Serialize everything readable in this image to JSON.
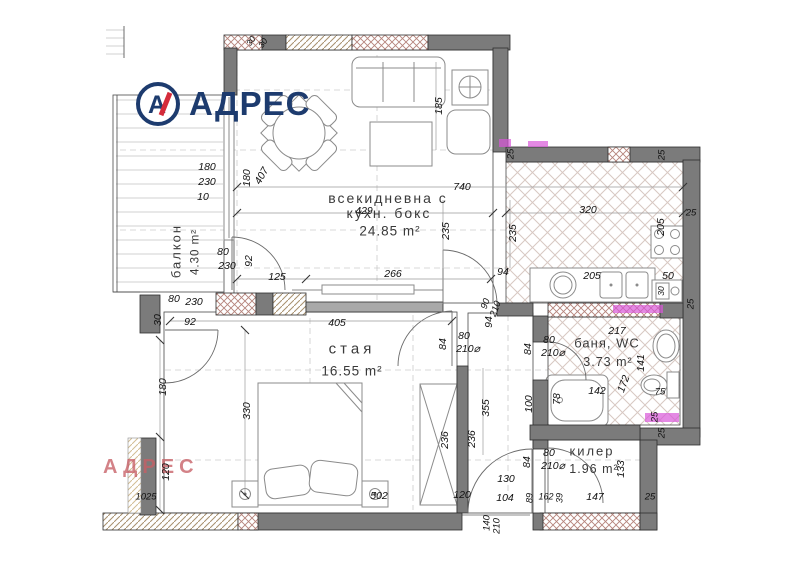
{
  "logo": {
    "brand": "АДРЕС",
    "monogram": "А"
  },
  "watermark": "АДРЕС",
  "colors": {
    "wall": "#7b7b7b",
    "navy": "#1d3b6e",
    "red": "#d42b3a",
    "wm": "#c75f66",
    "mag": "#d957d9"
  },
  "plan": {
    "rooms": [
      {
        "name": "всекидневна с кухн. бокс",
        "area": "24.85 m²"
      },
      {
        "name": "стая",
        "area": "16.55 m²"
      },
      {
        "name": "баня, WC",
        "area": "3.73 m²"
      },
      {
        "name": "килер",
        "area": "1.96 m²"
      },
      {
        "name": "балкон",
        "area": "4.30 m²"
      }
    ],
    "room_labels": [
      {
        "t": "всекидневна с",
        "x": 388,
        "y": 198,
        "s": 14,
        "ls": 2
      },
      {
        "t": "кухн. бокс",
        "x": 389,
        "y": 213,
        "s": 14,
        "ls": 2
      },
      {
        "t": "24.85 m²",
        "x": 390,
        "y": 231,
        "s": 13.5,
        "ls": 1
      },
      {
        "t": "стая",
        "x": 352,
        "y": 349,
        "s": 15,
        "ls": 4
      },
      {
        "t": "16.55 m²",
        "x": 352,
        "y": 371,
        "s": 13.5,
        "ls": 1
      },
      {
        "t": "баня, WC",
        "x": 607,
        "y": 343,
        "s": 13,
        "ls": 1
      },
      {
        "t": "3.73 m²",
        "x": 608,
        "y": 362,
        "s": 12.5,
        "ls": 1
      },
      {
        "t": "килер",
        "x": 592,
        "y": 451,
        "s": 13,
        "ls": 2
      },
      {
        "t": "1.96 m²",
        "x": 594,
        "y": 469,
        "s": 12.5,
        "ls": 1
      },
      {
        "t": "балкон",
        "x": 176,
        "y": 251,
        "s": 13,
        "ls": 2,
        "r": -90
      },
      {
        "t": "4.30 m²",
        "x": 196,
        "y": 252,
        "s": 11.5,
        "ls": 1,
        "r": -90
      }
    ],
    "dim_labels": [
      {
        "t": "740",
        "x": 462,
        "y": 187
      },
      {
        "t": "429",
        "x": 364,
        "y": 211
      },
      {
        "t": "235",
        "x": 446,
        "y": 231,
        "r": -90
      },
      {
        "t": "235",
        "x": 513,
        "y": 233,
        "r": -90
      },
      {
        "t": "185",
        "x": 439,
        "y": 106,
        "r": -90
      },
      {
        "t": "30",
        "x": 251,
        "y": 41,
        "r": -55,
        "s": 8.5
      },
      {
        "t": "30",
        "x": 263,
        "y": 43,
        "r": -55,
        "s": 8.5
      },
      {
        "t": "180",
        "x": 207,
        "y": 167
      },
      {
        "t": "230",
        "x": 207,
        "y": 182
      },
      {
        "t": "10",
        "x": 203,
        "y": 197
      },
      {
        "t": "407",
        "x": 262,
        "y": 176,
        "r": -60
      },
      {
        "t": "180",
        "x": 247,
        "y": 178,
        "r": -90
      },
      {
        "t": "80",
        "x": 223,
        "y": 252
      },
      {
        "t": "230",
        "x": 227,
        "y": 266
      },
      {
        "t": "92",
        "x": 249,
        "y": 261,
        "r": -90
      },
      {
        "t": "80",
        "x": 174,
        "y": 299
      },
      {
        "t": "230",
        "x": 194,
        "y": 302
      },
      {
        "t": "30",
        "x": 158,
        "y": 320,
        "r": -90
      },
      {
        "t": "92",
        "x": 190,
        "y": 322
      },
      {
        "t": "125",
        "x": 277,
        "y": 277
      },
      {
        "t": "266",
        "x": 393,
        "y": 274
      },
      {
        "t": "405",
        "x": 337,
        "y": 323
      },
      {
        "t": "94",
        "x": 503,
        "y": 272
      },
      {
        "t": "90",
        "x": 486,
        "y": 304,
        "r": -70,
        "s": 9.5
      },
      {
        "t": "210",
        "x": 496,
        "y": 309,
        "r": -70,
        "s": 9.5
      },
      {
        "t": "94",
        "x": 489,
        "y": 322,
        "r": -90
      },
      {
        "t": "320",
        "x": 588,
        "y": 210
      },
      {
        "t": "205",
        "x": 661,
        "y": 227,
        "r": -90
      },
      {
        "t": "205",
        "x": 592,
        "y": 276
      },
      {
        "t": "50",
        "x": 668,
        "y": 276
      },
      {
        "t": "30",
        "x": 661,
        "y": 291,
        "r": -90,
        "s": 8.5
      },
      {
        "t": "25",
        "x": 511,
        "y": 154,
        "r": -90,
        "s": 9.5
      },
      {
        "t": "25",
        "x": 662,
        "y": 155,
        "r": -90,
        "s": 9.5
      },
      {
        "t": "25",
        "x": 691,
        "y": 213,
        "s": 9.5
      },
      {
        "t": "25",
        "x": 691,
        "y": 304,
        "r": -90,
        "s": 9.5
      },
      {
        "t": "330",
        "x": 247,
        "y": 411,
        "r": -90
      },
      {
        "t": "502",
        "x": 379,
        "y": 496
      },
      {
        "t": "236",
        "x": 445,
        "y": 440,
        "r": -90
      },
      {
        "t": "236",
        "x": 472,
        "y": 439,
        "r": -90
      },
      {
        "t": "355",
        "x": 486,
        "y": 408,
        "r": -90
      },
      {
        "t": "120",
        "x": 462,
        "y": 495
      },
      {
        "t": "180",
        "x": 163,
        "y": 387,
        "r": -90
      },
      {
        "t": "120",
        "x": 166,
        "y": 472,
        "r": -90
      },
      {
        "t": "1025",
        "x": 146,
        "y": 497,
        "s": 9.5
      },
      {
        "t": "84",
        "x": 443,
        "y": 344,
        "r": -90
      },
      {
        "t": "80",
        "x": 464,
        "y": 336
      },
      {
        "t": "210⌀",
        "x": 468,
        "y": 349
      },
      {
        "t": "84",
        "x": 528,
        "y": 349,
        "r": -90
      },
      {
        "t": "80",
        "x": 549,
        "y": 340
      },
      {
        "t": "210⌀",
        "x": 553,
        "y": 353
      },
      {
        "t": "100",
        "x": 529,
        "y": 404,
        "r": -90
      },
      {
        "t": "78",
        "x": 557,
        "y": 399,
        "r": -90
      },
      {
        "t": "142",
        "x": 597,
        "y": 391
      },
      {
        "t": "172",
        "x": 624,
        "y": 384,
        "r": -70
      },
      {
        "t": "141",
        "x": 641,
        "y": 363,
        "r": -90
      },
      {
        "t": "75",
        "x": 660,
        "y": 392,
        "s": 9.5
      },
      {
        "t": "217",
        "x": 617,
        "y": 331
      },
      {
        "t": "25",
        "x": 655,
        "y": 417,
        "r": -90,
        "s": 9.5
      },
      {
        "t": "84",
        "x": 527,
        "y": 462,
        "r": -90
      },
      {
        "t": "80",
        "x": 549,
        "y": 453
      },
      {
        "t": "210⌀",
        "x": 553,
        "y": 466
      },
      {
        "t": "133",
        "x": 621,
        "y": 469,
        "r": -90
      },
      {
        "t": "147",
        "x": 595,
        "y": 497
      },
      {
        "t": "25",
        "x": 650,
        "y": 497,
        "s": 9.5
      },
      {
        "t": "25",
        "x": 662,
        "y": 433,
        "r": -90,
        "s": 9.5
      },
      {
        "t": "89",
        "x": 530,
        "y": 498,
        "r": -90,
        "s": 9
      },
      {
        "t": "162",
        "x": 546,
        "y": 497,
        "s": 9
      },
      {
        "t": "39",
        "x": 560,
        "y": 498,
        "r": -90,
        "s": 9
      },
      {
        "t": "130",
        "x": 506,
        "y": 479
      },
      {
        "t": "104",
        "x": 505,
        "y": 498
      },
      {
        "t": "140",
        "x": 487,
        "y": 523,
        "r": -90,
        "s": 9.5
      },
      {
        "t": "210",
        "x": 497,
        "y": 526,
        "r": -90,
        "s": 9.5
      }
    ]
  }
}
